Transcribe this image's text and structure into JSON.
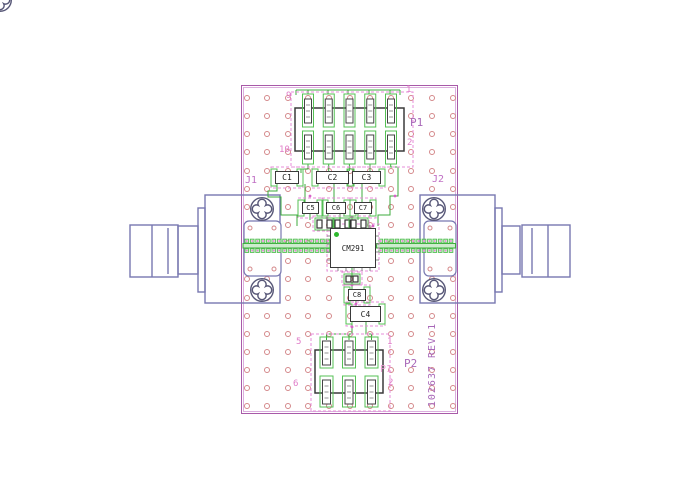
{
  "drawing": {
    "type": "PCB layout drawing",
    "rev_text": "102637 REV 1"
  },
  "silkscreen": {
    "j1": "J1",
    "j2": "J2",
    "rev": "102637 REV 1"
  },
  "top_header": {
    "label": "P1",
    "pin_top_left": "9",
    "pin_top_right": "1",
    "pin_bottom_left": "10",
    "pin_bottom_right": "2"
  },
  "bottom_header": {
    "label": "P2",
    "label_alt": "P1",
    "pin_top_left": "5",
    "pin_top_right": "1",
    "pin_bottom_left": "6",
    "pin_bottom_right": "2"
  },
  "components": {
    "ic": "CM291",
    "c1": "C1",
    "c2": "C2",
    "c3": "C3",
    "c4": "C4",
    "c5": "C5",
    "c6": "C6",
    "c7": "C7",
    "c8": "C8"
  },
  "colors": {
    "board_outline": "#a85aa8",
    "trace_green": "#3cab3c",
    "pad_green": "#55c055",
    "silk_pink": "#e07cc8",
    "silk_purple": "#a868b8",
    "connector_blue": "#7878b0",
    "screw_gray": "#585878",
    "via_pink": "#d4888a",
    "component_outline": "#3a3a3a"
  }
}
